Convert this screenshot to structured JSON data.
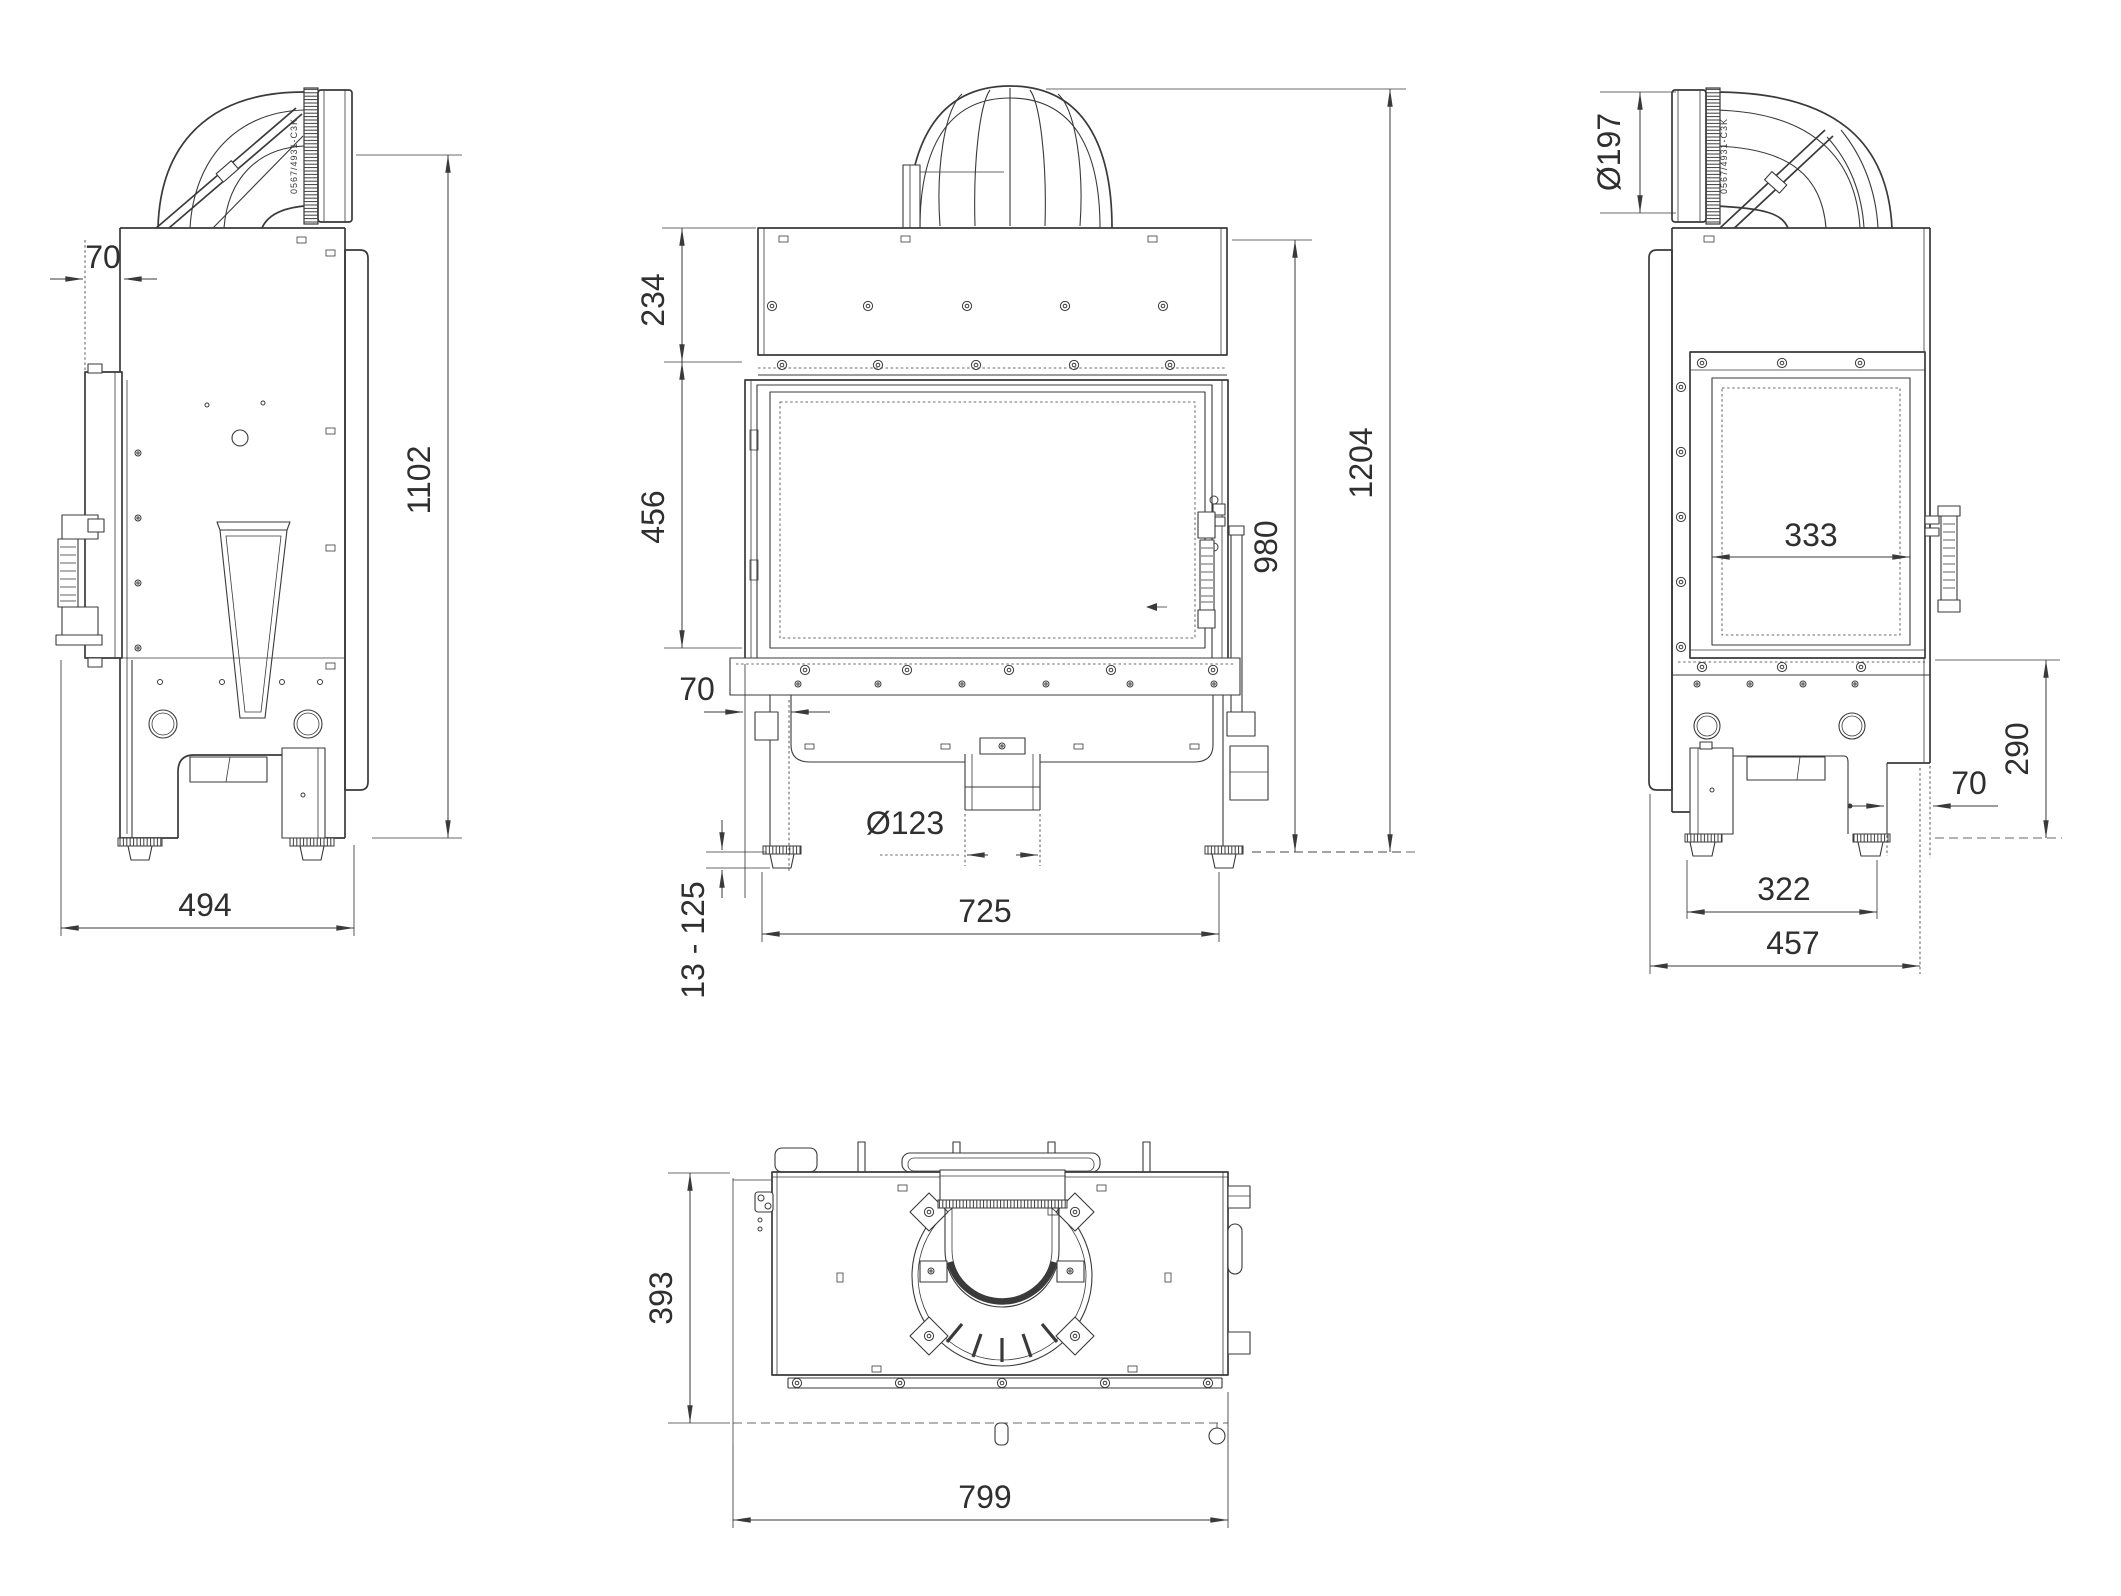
{
  "meta": {
    "description": "Technical dimension drawing of a fireplace insert, four orthographic views",
    "background_color": "#ffffff",
    "line_color": "#3a3a3a",
    "unit": "mm"
  },
  "views": {
    "left_side": {
      "name": "left-side-view",
      "pipe_marking": "0567/4931-C3K",
      "dims": {
        "front_frame_offset": "70",
        "height_to_flue_axis": "1102",
        "base_depth": "494"
      }
    },
    "front": {
      "name": "front-view",
      "dims": {
        "upper_section_height": "234",
        "door_glass_height": "456",
        "base_recess": "70",
        "body_height": "980",
        "total_height": "1204",
        "air_inlet_diameter": "Ø123",
        "leveling_feet_range": "13 - 125",
        "feet_span_width": "725"
      }
    },
    "right_side": {
      "name": "right-side-view",
      "pipe_marking": "0567/4931-C3K",
      "dims": {
        "flue_outlet_diameter": "Ø197",
        "side_glass_width": "333",
        "plinth_height": "290",
        "front_offset": "70",
        "feet_span_depth": "322",
        "total_depth": "457"
      }
    },
    "top": {
      "name": "top-view",
      "dims": {
        "body_depth": "393",
        "body_width": "799"
      }
    }
  }
}
